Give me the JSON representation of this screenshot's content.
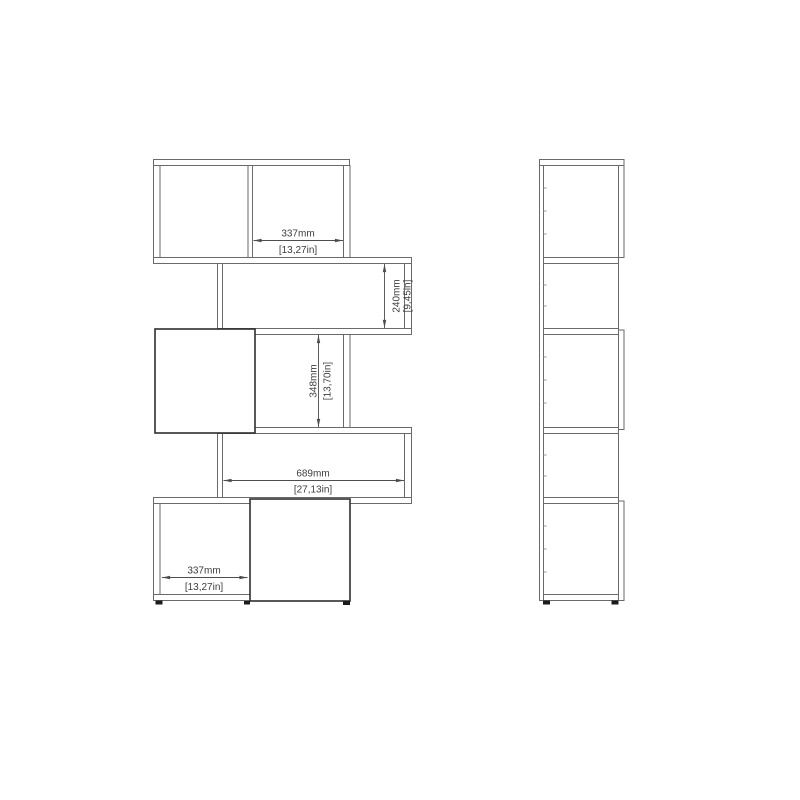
{
  "colors": {
    "page_background": "#ffffff",
    "structure_line": "#6a6a6a",
    "door_line": "#2f2f2f",
    "dimension_line": "#4d4d4d",
    "dimension_text": "#3d3d3d",
    "foot_fill": "#1c1c1c"
  },
  "dimensions": {
    "top_shelf_width": {
      "mm": "337mm",
      "inches": "[13,27in]"
    },
    "shelf2_height": {
      "mm": "240mm",
      "inches": "[9,45in]"
    },
    "shelf3_height": {
      "mm": "348mm",
      "inches": "[13,70in]"
    },
    "interior_width": {
      "mm": "689mm",
      "inches": "[27,13in]"
    },
    "bottom_shelf_width": {
      "mm": "337mm",
      "inches": "[13,27in]"
    }
  }
}
